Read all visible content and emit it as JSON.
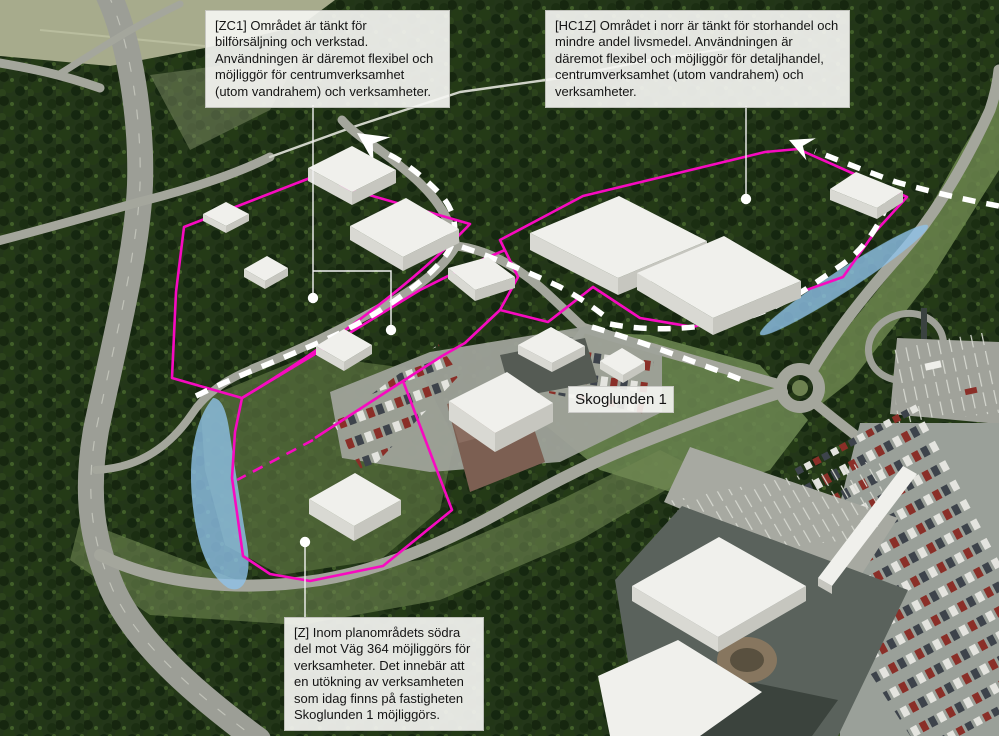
{
  "figure": {
    "type": "aerial-planning-map",
    "property_label": "Skoglunden 1",
    "callouts": {
      "zc1": "[ZC1] Området är tänkt för bilförsäljning och verkstad. Användningen är däremot flexibel och möjliggör för centrumverksamhet (utom vandrahem) och verksamheter.",
      "hc1z": "[HC1Z] Området i norr är tänkt för storhandel och mindre andel livsmedel. Användningen är däremot flexibel och möjliggör för detaljhandel, centrumverksamhet (utom vandrahem) och verksamheter.",
      "z": "[Z] Inom planområdets södra del mot Väg 364 möjliggörs för verksamheter. Det innebär att en utökning av verksamheten som idag finns på fastigheten Skoglunden 1 möjliggörs."
    },
    "colors": {
      "plan_boundary": "#f70ac0",
      "water_overlay": "#8fc2e9",
      "route_dash": "#ffffff",
      "building_roof": "#f0f0ec",
      "callout_bg": "#f5f5f2"
    }
  }
}
